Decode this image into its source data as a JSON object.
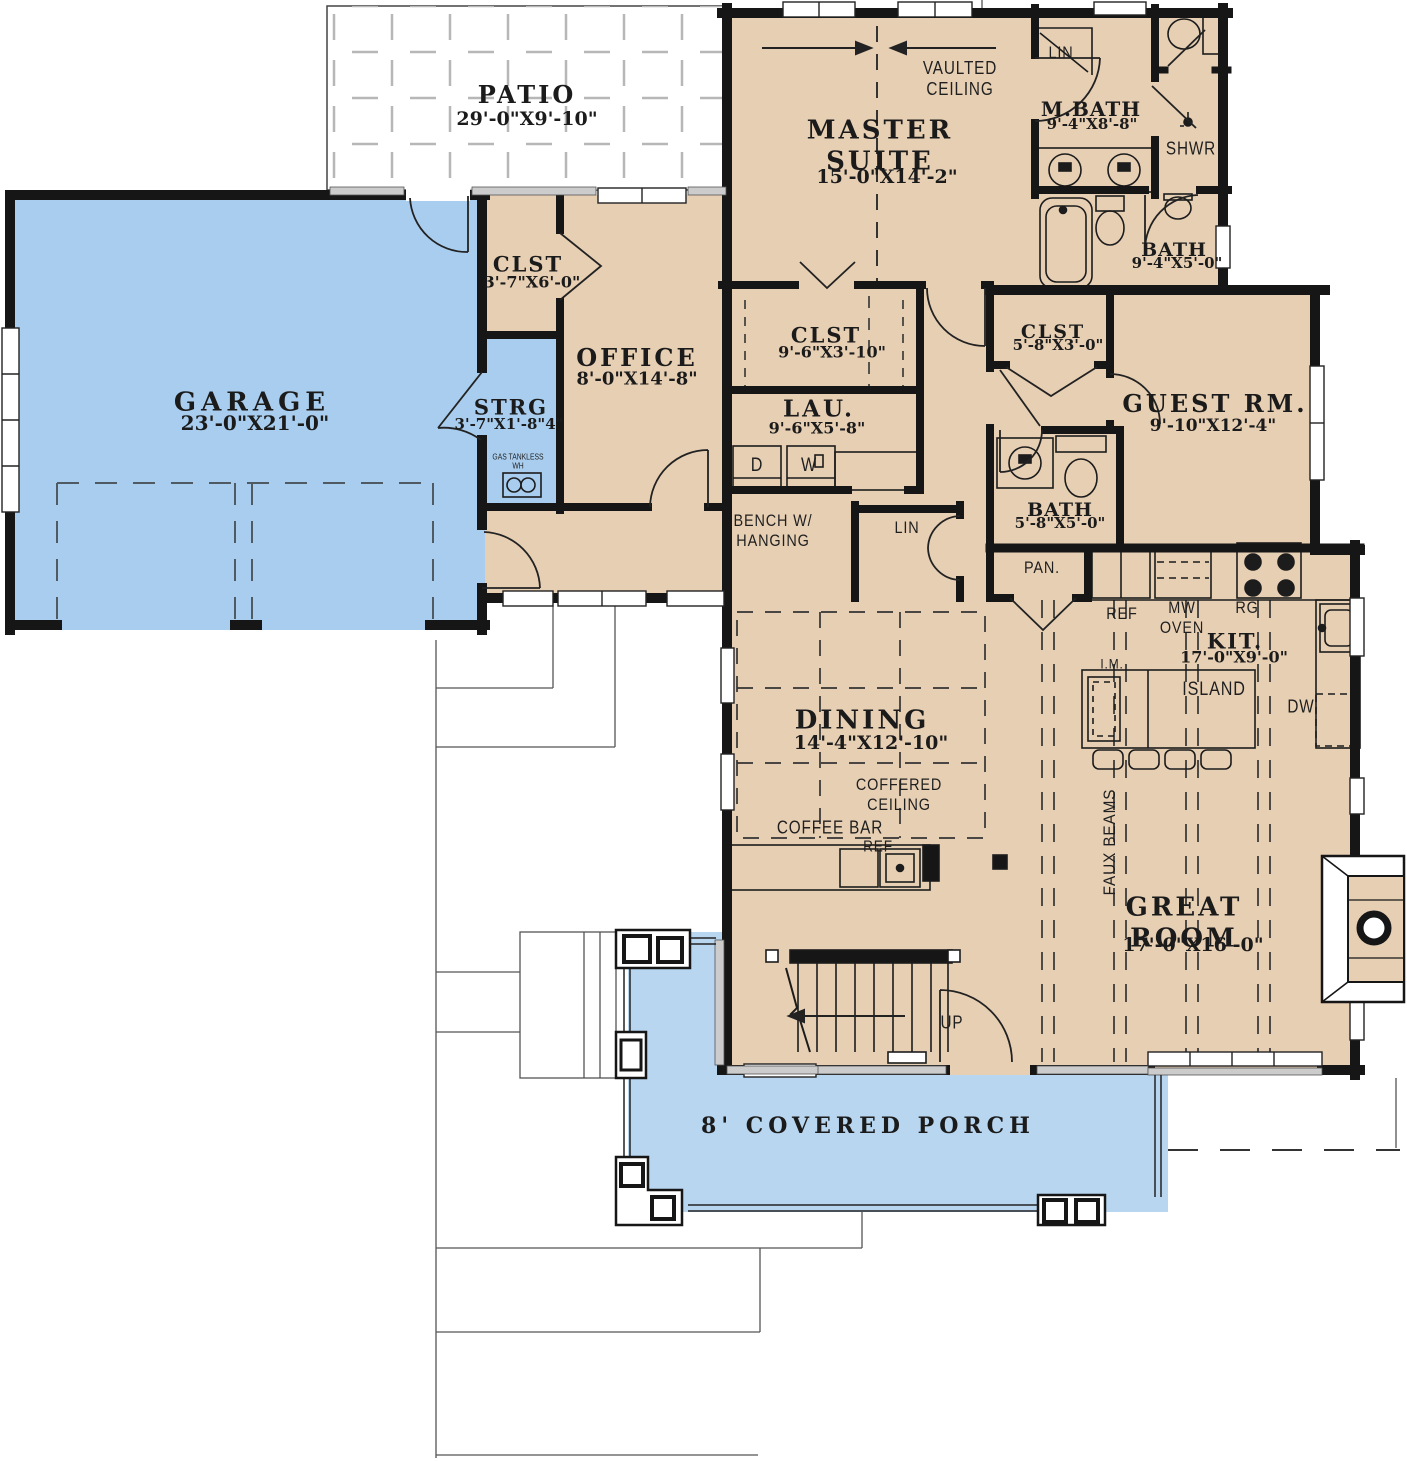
{
  "colors": {
    "floor_tan": "#e7cfb4",
    "garage_blue": "#a9cdee",
    "porch_blue": "#b8d6f0",
    "wall_black": "#161616",
    "sill_gray": "#cccccc"
  },
  "rooms": [
    {
      "name": "PATIO",
      "dims": "29'-0\"X9'-10\""
    },
    {
      "name": "MASTER\nSUITE",
      "dims": "15'-0\"X14'-2\""
    },
    {
      "name": "M.BATH",
      "dims": "9'-4\"X8'-8\""
    },
    {
      "name": "BATH",
      "dims": "9'-4\"X5'-0\""
    },
    {
      "name": "GARAGE",
      "dims": "23'-0\"X21'-0\""
    },
    {
      "name": "CLST",
      "dims": "3'-7\"X6'-0\""
    },
    {
      "name": "OFFICE",
      "dims": "8'-0\"X14'-8\""
    },
    {
      "name": "STRG",
      "dims": "3'-7\"X1'-8\"4\""
    },
    {
      "name": "CLST",
      "dims": "9'-6\"X3'-10\""
    },
    {
      "name": "LAU.",
      "dims": "9'-6\"X5'-8\""
    },
    {
      "name": "CLST",
      "dims": "5'-8\"X3'-0\""
    },
    {
      "name": "GUEST RM.",
      "dims": "9'-10\"X12'-4\""
    },
    {
      "name": "BATH",
      "dims": "5'-8\"X5'-0\""
    },
    {
      "name": "DINING",
      "dims": "14'-4\"X12'-10\""
    },
    {
      "name": "KIT.",
      "dims": "17'-0\"X9'-0\""
    },
    {
      "name": "GREAT ROOM",
      "dims": "17'-0\"X16'-0\""
    },
    {
      "name": "8' COVERED PORCH",
      "dims": ""
    }
  ],
  "annotations": [
    {
      "text": "VAULTED\nCEILING"
    },
    {
      "text": "LIN"
    },
    {
      "text": "SHWR"
    },
    {
      "text": "BENCH W/\nHANGING"
    },
    {
      "text": "LIN"
    },
    {
      "text": "PAN."
    },
    {
      "text": "REF"
    },
    {
      "text": "MW\nOVEN"
    },
    {
      "text": "RG"
    },
    {
      "text": "I.M."
    },
    {
      "text": "ISLAND"
    },
    {
      "text": "DW"
    },
    {
      "text": "COFFERED\nCEILING"
    },
    {
      "text": "COFFEE BAR"
    },
    {
      "text": "REF"
    },
    {
      "text": "FAUX BEAMS"
    },
    {
      "text": "UP"
    },
    {
      "text": "D"
    },
    {
      "text": "W"
    },
    {
      "text": "GAS TANKLESS\nWH"
    }
  ]
}
